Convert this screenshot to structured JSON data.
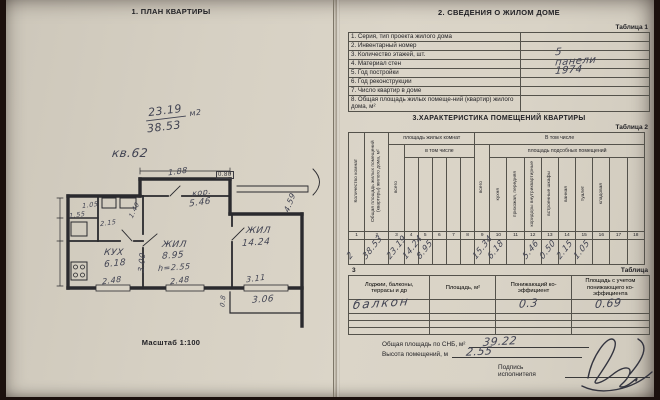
{
  "colors": {
    "paper": "#d8d2c5",
    "ink": "#1f1f23",
    "hand_ink": "#414352",
    "background": "#1b100d"
  },
  "left_page": {
    "title": "1. ПЛАН КВАРТИРЫ",
    "scale_label": "Масштаб 1:100",
    "note_fraction_top": "23.19",
    "note_fraction_bottom": "38.53",
    "note_unit": "м2",
    "note_apartment": "кв.62",
    "plan_labels": [
      {
        "t": "1.88",
        "x": 128,
        "y": 11,
        "r": -8,
        "s": "sm"
      },
      {
        "t": "0.80",
        "x": 176,
        "y": 15,
        "r": 0,
        "s": "box"
      },
      {
        "t": "кор.",
        "x": 152,
        "y": 32,
        "r": -8,
        "s": "sm"
      },
      {
        "t": "5.46",
        "x": 149,
        "y": 42,
        "r": -8,
        "s": "md"
      },
      {
        "t": "1.05",
        "x": 42,
        "y": 45,
        "r": -8,
        "s": "xs"
      },
      {
        "t": "2.15",
        "x": 60,
        "y": 63,
        "r": -8,
        "s": "xs"
      },
      {
        "t": "1.55",
        "x": 29,
        "y": 55,
        "r": -8,
        "s": "xs"
      },
      {
        "t": "1.40",
        "x": 86,
        "y": 50,
        "r": -65,
        "s": "xs"
      },
      {
        "t": "КУХ",
        "x": 64,
        "y": 92,
        "r": 0,
        "s": "md"
      },
      {
        "t": "6.18",
        "x": 64,
        "y": 103,
        "r": -6,
        "s": "md"
      },
      {
        "t": "ЖИЛ",
        "x": 122,
        "y": 84,
        "r": 0,
        "s": "md"
      },
      {
        "t": "8.95",
        "x": 122,
        "y": 95,
        "r": -4,
        "s": "md"
      },
      {
        "t": "h=2.55",
        "x": 118,
        "y": 107,
        "r": -4,
        "s": "sm"
      },
      {
        "t": "ЖИЛ",
        "x": 206,
        "y": 70,
        "r": 0,
        "s": "md"
      },
      {
        "t": "14.24",
        "x": 202,
        "y": 82,
        "r": -4,
        "s": "md"
      },
      {
        "t": "4.59",
        "x": 240,
        "y": 42,
        "r": -70,
        "s": "sm"
      },
      {
        "t": "3.00",
        "x": 92,
        "y": 102,
        "r": -85,
        "s": "sm"
      },
      {
        "t": "2.48",
        "x": 62,
        "y": 120,
        "r": -8,
        "s": "sm"
      },
      {
        "t": "2.48",
        "x": 130,
        "y": 120,
        "r": -8,
        "s": "sm"
      },
      {
        "t": "3.11",
        "x": 206,
        "y": 118,
        "r": -8,
        "s": "sm"
      },
      {
        "t": "0.8",
        "x": 177,
        "y": 141,
        "r": -85,
        "s": "xs"
      },
      {
        "t": "3.06",
        "x": 212,
        "y": 139,
        "r": -4,
        "s": "md"
      }
    ]
  },
  "right_page": {
    "title": "2. СВЕДЕНИЯ О ЖИЛОМ ДОМЕ",
    "table1": {
      "caption": "Таблица 1",
      "rows": [
        {
          "label": "1. Серия, тип проекта жилого дома",
          "value": ""
        },
        {
          "label": "2. Инвентарный номер",
          "value": ""
        },
        {
          "label": "3. Количество этажей, шт.",
          "value": "5"
        },
        {
          "label": "4. Материал стен",
          "value": "панели"
        },
        {
          "label": "5. Год постройки",
          "value": "1974"
        },
        {
          "label": "6. Год реконструкции",
          "value": ""
        },
        {
          "label": "7. Число квартир в доме",
          "value": ""
        },
        {
          "label": "8. Общая площадь жилых помеще-ний (квартир) жилого дома, м²",
          "value": ""
        }
      ]
    },
    "section3_title": "3.ХАРАКТЕРИСТИКА ПОМЕЩЕНИЙ КВАРТИРЫ",
    "table2": {
      "caption": "Таблица 2",
      "h_rooms_count": "Количество комнат",
      "h_total_area": "Общая площадь жилых помещений (квартиры) жилого дома, м²",
      "h_living_group": "площадь жилых комнат",
      "h_incl_top": "В том числе",
      "h_incl_sub": "в том числе",
      "h_total_living": "всего",
      "h_total_aux": "всего",
      "h_aux_group": "площадь подсобных помещений",
      "sub_labels": [
        "кухня",
        "прихожая, передняя",
        "коридоры внутриквартирные",
        "встроенные шкафы",
        "ванная",
        "туалет",
        "кладовая",
        "",
        ""
      ],
      "col_numbers": [
        "1",
        "2",
        "3",
        "4",
        "5",
        "6",
        "7",
        "8",
        "9",
        "10",
        "11",
        "12",
        "13",
        "14",
        "15",
        "16",
        "17",
        "18"
      ],
      "values": [
        "2",
        "38.53",
        "23.19",
        "14.24",
        "8.95",
        "",
        "",
        "",
        "15.34",
        "6.18",
        "",
        "5.46",
        "0.50",
        "2.15",
        "1.05",
        "",
        "",
        ""
      ]
    },
    "table3": {
      "caption_word": "Таблица",
      "caption_num": "3",
      "headers": [
        "Лоджии, балконы,\nтеррасы и др",
        "Площадь, м²",
        "Понижающий ко-\nэффициент",
        "Площадь с учетом\nпонижающего ко-\nэффициента"
      ],
      "rows": [
        [
          "балкон",
          "",
          "0.3",
          "0.69"
        ],
        [
          "",
          "",
          "",
          ""
        ],
        [
          "",
          "",
          "",
          ""
        ],
        [
          "",
          "",
          "",
          ""
        ]
      ]
    },
    "footer": {
      "snb_label": "Общая площадь по СНБ, м²",
      "snb_value": "39.22",
      "height_label": "Высота помещений, м",
      "height_value": "2.55",
      "sign_label": "Подпись исполнителя"
    }
  }
}
